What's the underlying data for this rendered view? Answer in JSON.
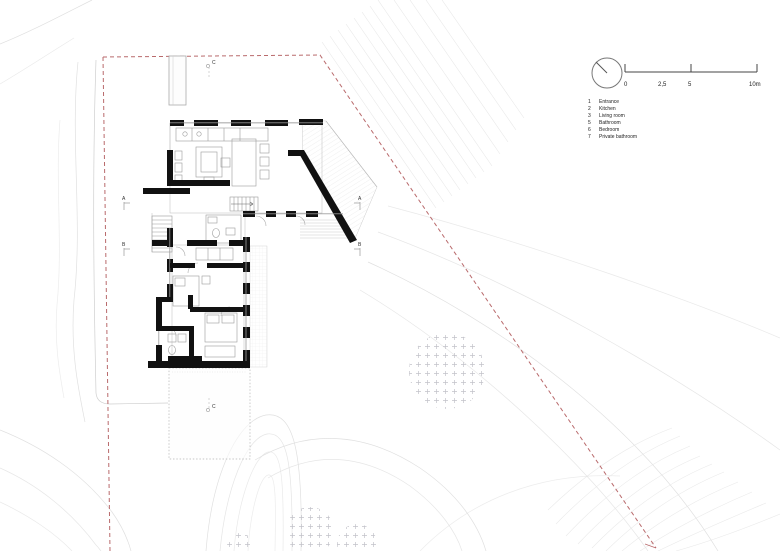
{
  "title": "house-site-plan",
  "colors": {
    "boundary_red": "#b96a6c",
    "wall_black": "#111111",
    "detail_grey": "#999999",
    "contour_grey": "#e0e0e0",
    "tree_grey": "#c2c2c9"
  },
  "scalebar": {
    "labels": [
      "0",
      "2,5",
      "5",
      "10m"
    ]
  },
  "legend": {
    "items": [
      {
        "num": "1",
        "label": "Entrance"
      },
      {
        "num": "2",
        "label": "Kitchen"
      },
      {
        "num": "3",
        "label": "Living room"
      },
      {
        "num": "5",
        "label": "Bathroom"
      },
      {
        "num": "6",
        "label": "Bedroom"
      },
      {
        "num": "7",
        "label": "Private bathroom"
      }
    ]
  },
  "markers": {
    "a": "A",
    "b": "B",
    "c": "C"
  }
}
